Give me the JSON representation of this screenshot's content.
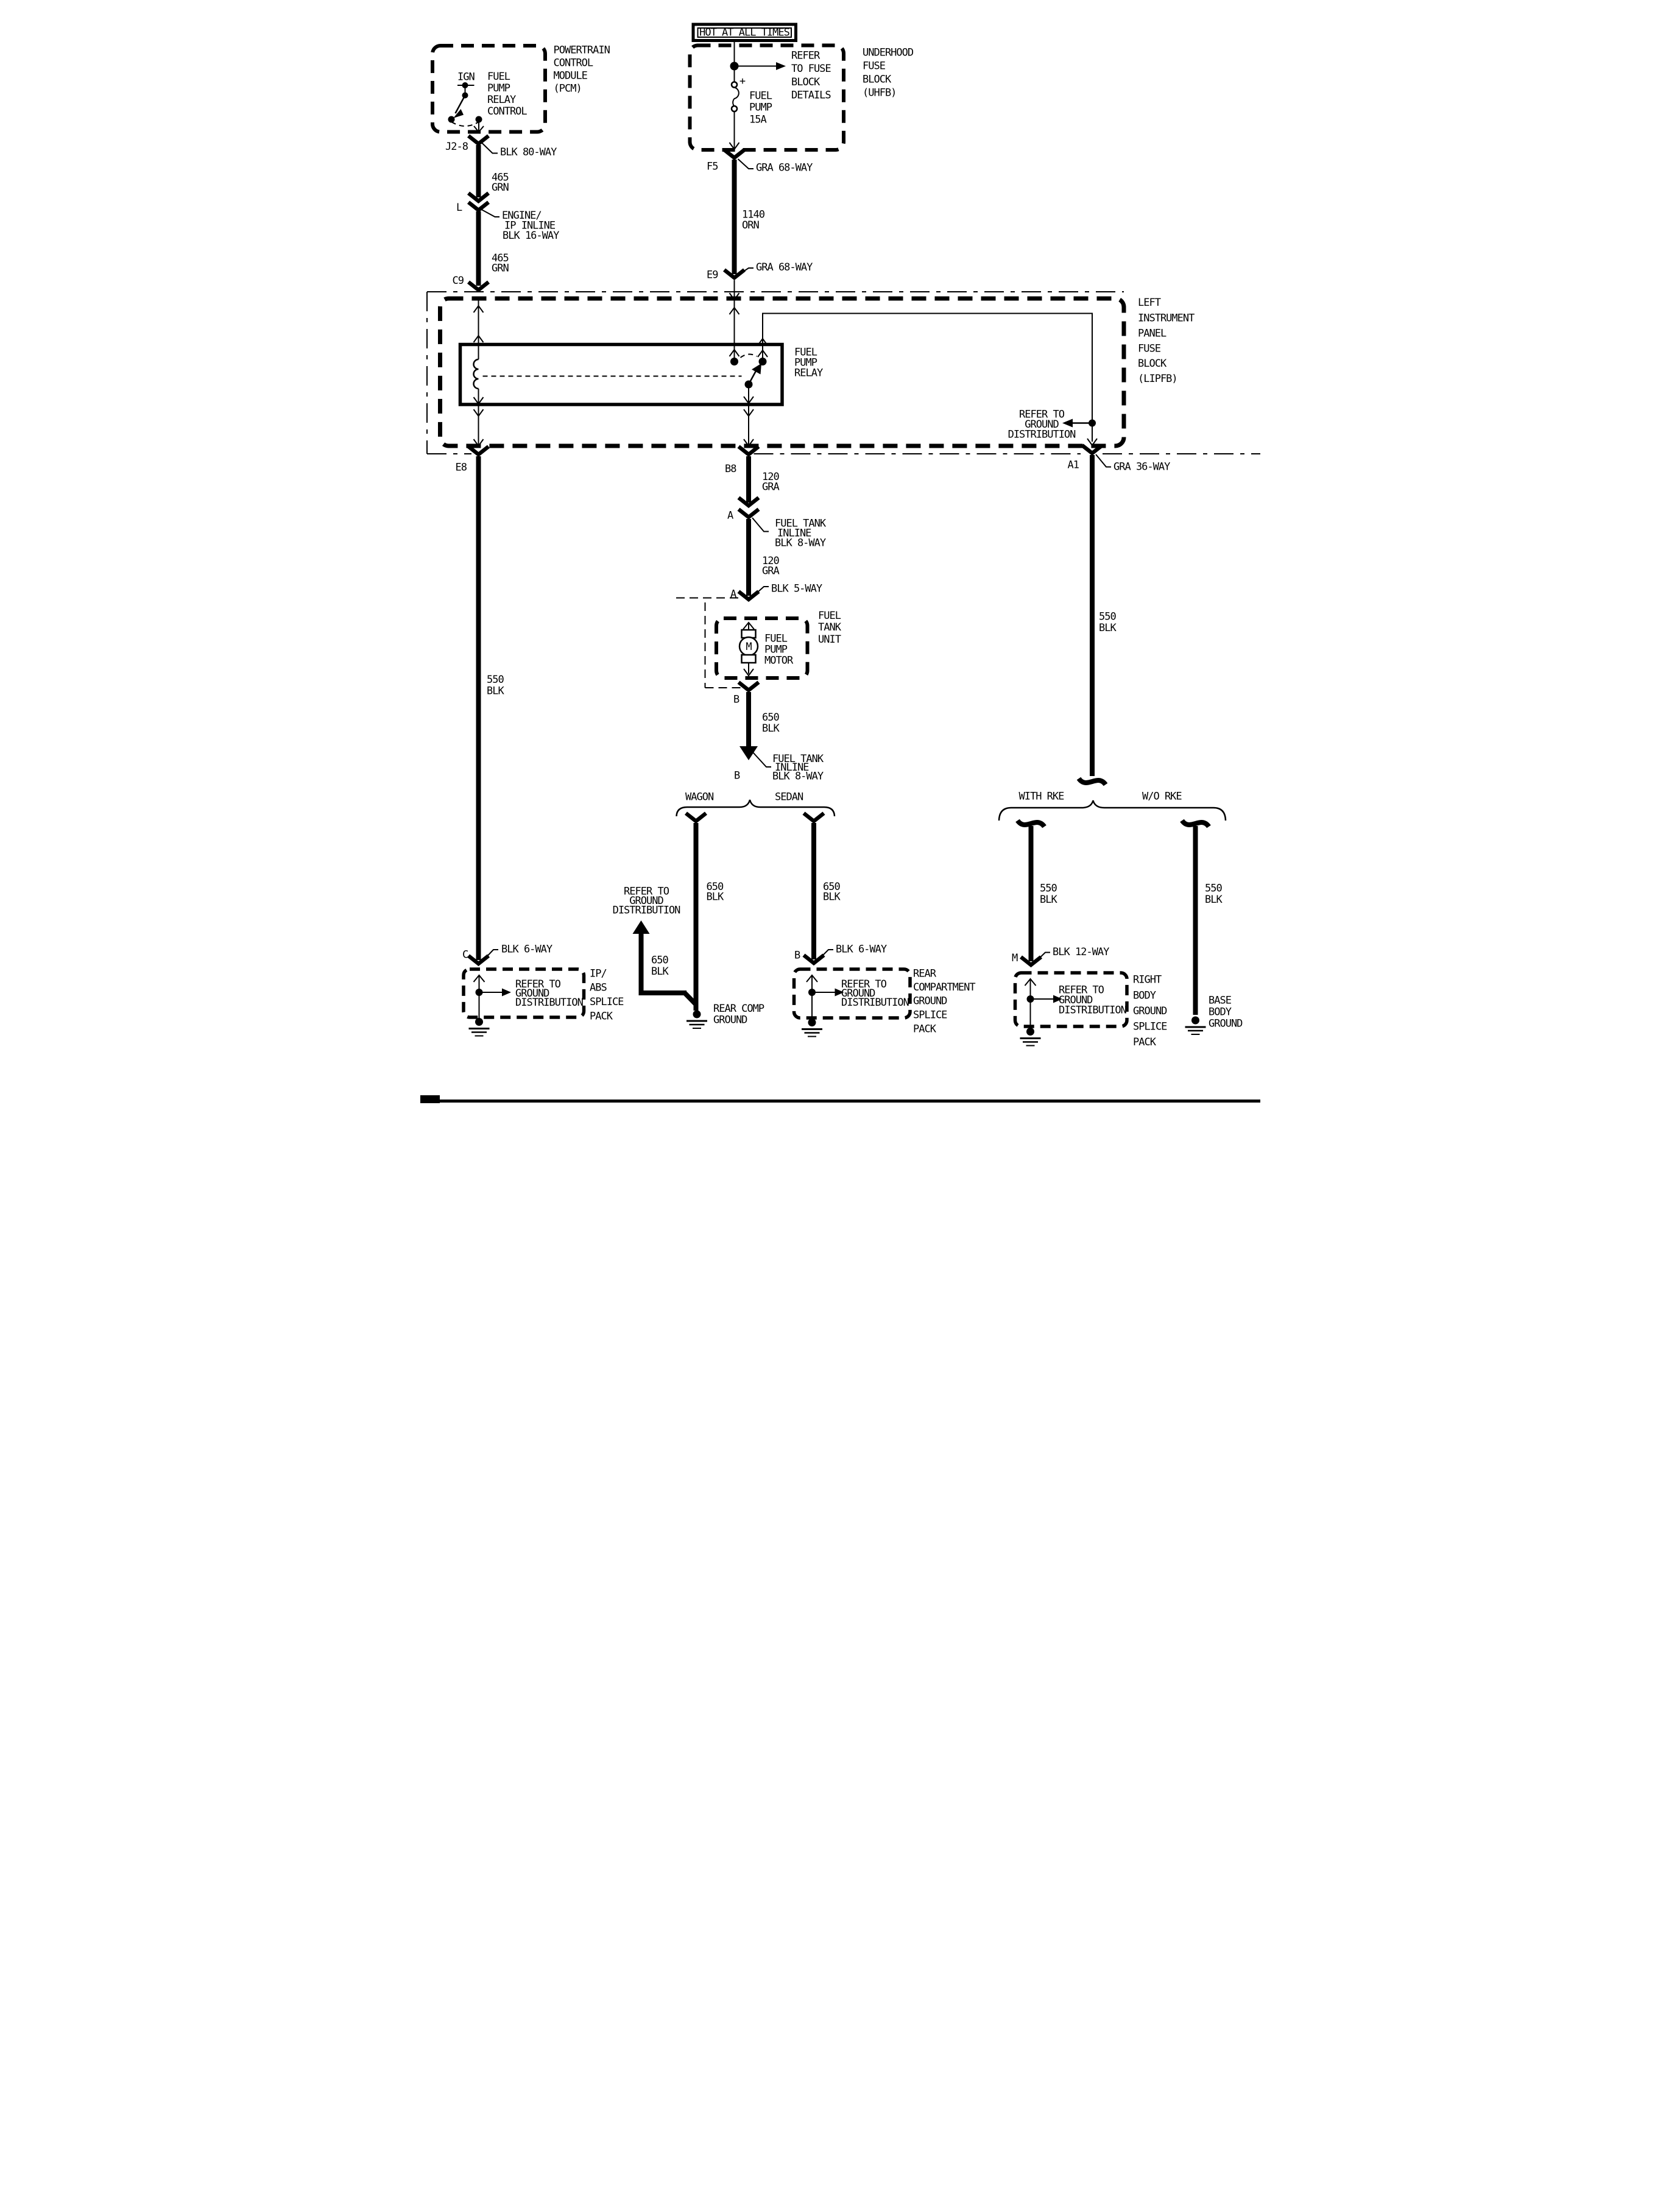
{
  "colors": {
    "ink": "#000000",
    "paper": "#ffffff"
  },
  "banner": {
    "text": "HOT AT ALL TIMES"
  },
  "pcm": {
    "label": [
      "POWERTRAIN",
      "CONTROL",
      "MODULE",
      "(PCM)"
    ],
    "ign": "IGN",
    "control": [
      "FUEL",
      "PUMP",
      "RELAY",
      "CONTROL"
    ],
    "pin": "J2-8",
    "connector": "BLK 80-WAY"
  },
  "uhfb": {
    "label": [
      "UNDERHOOD",
      "FUSE",
      "BLOCK",
      "(UHFB)"
    ],
    "refer": [
      "REFER",
      "TO FUSE",
      "BLOCK",
      "DETAILS"
    ],
    "fuse": [
      "FUEL",
      "PUMP",
      "15A"
    ],
    "plus": "+",
    "pin": "F5",
    "connector": "GRA 68-WAY"
  },
  "wires": {
    "w465a": [
      "465",
      "GRN"
    ],
    "w465b": [
      "465",
      "GRN"
    ],
    "w1140": [
      "1140",
      "ORN"
    ],
    "w120a": [
      "120",
      "GRA"
    ],
    "w120b": [
      "120",
      "GRA"
    ],
    "w650tank": [
      "650",
      "BLK"
    ],
    "w650wagon": [
      "650",
      "BLK"
    ],
    "w650sedan": [
      "650",
      "BLK"
    ],
    "w650branch": [
      "650",
      "BLK"
    ],
    "w550left": [
      "550",
      "BLK"
    ],
    "w550a1": [
      "550",
      "BLK"
    ],
    "w550rke": [
      "550",
      "BLK"
    ],
    "w550worke": [
      "550",
      "BLK"
    ]
  },
  "inline_l": {
    "pin": "L",
    "label": [
      "ENGINE/",
      "IP INLINE",
      "BLK 16-WAY"
    ]
  },
  "lipfb": {
    "pin_c9": "C9",
    "pin_e9": "E9",
    "e9_connector": "GRA 68-WAY",
    "label": [
      "LEFT",
      "INSTRUMENT",
      "PANEL",
      "FUSE",
      "BLOCK",
      "(LIPFB)"
    ],
    "relay": [
      "FUEL",
      "PUMP",
      "RELAY"
    ],
    "refer": [
      "REFER TO",
      "GROUND",
      "DISTRIBUTION"
    ],
    "pin_e8": "E8",
    "pin_b8": "B8",
    "pin_a1": "A1",
    "a1_connector": "GRA 36-WAY"
  },
  "inline_tank_a": {
    "pin": "A",
    "label": [
      "FUEL TANK",
      "INLINE",
      "BLK 8-WAY"
    ]
  },
  "conn_5way": {
    "pin": "A",
    "label": "BLK 5-WAY"
  },
  "tank": {
    "label": [
      "FUEL",
      "TANK",
      "UNIT"
    ],
    "motor": [
      "FUEL",
      "PUMP",
      "MOTOR"
    ],
    "m": "M",
    "pin": "B"
  },
  "inline_tank_b": {
    "pin": "B",
    "label": [
      "FUEL TANK",
      "INLINE",
      "BLK 8-WAY"
    ]
  },
  "body_split": {
    "left": "WAGON",
    "right": "SEDAN"
  },
  "rke_split": {
    "left": "WITH RKE",
    "right": "W/O RKE"
  },
  "wagon_branch": {
    "refer": [
      "REFER TO",
      "GROUND",
      "DISTRIBUTION"
    ],
    "ground": [
      "REAR COMP",
      "GROUND"
    ]
  },
  "ip_abs": {
    "pin": "C",
    "connector": "BLK 6-WAY",
    "refer": [
      "REFER TO",
      "GROUND",
      "DISTRIBUTION"
    ],
    "label": [
      "IP/",
      "ABS",
      "SPLICE",
      "PACK"
    ]
  },
  "rear_comp": {
    "pin": "B",
    "connector": "BLK 6-WAY",
    "refer": [
      "REFER TO",
      "GROUND",
      "DISTRIBUTION"
    ],
    "label": [
      "REAR",
      "COMPARTMENT",
      "GROUND",
      "SPLICE",
      "PACK"
    ]
  },
  "right_body": {
    "pin": "M",
    "connector": "BLK 12-WAY",
    "refer": [
      "REFER TO",
      "GROUND",
      "DISTRIBUTION"
    ],
    "label": [
      "RIGHT",
      "BODY",
      "GROUND",
      "SPLICE",
      "PACK"
    ]
  },
  "base_body": {
    "label": [
      "BASE",
      "BODY",
      "GROUND"
    ]
  }
}
